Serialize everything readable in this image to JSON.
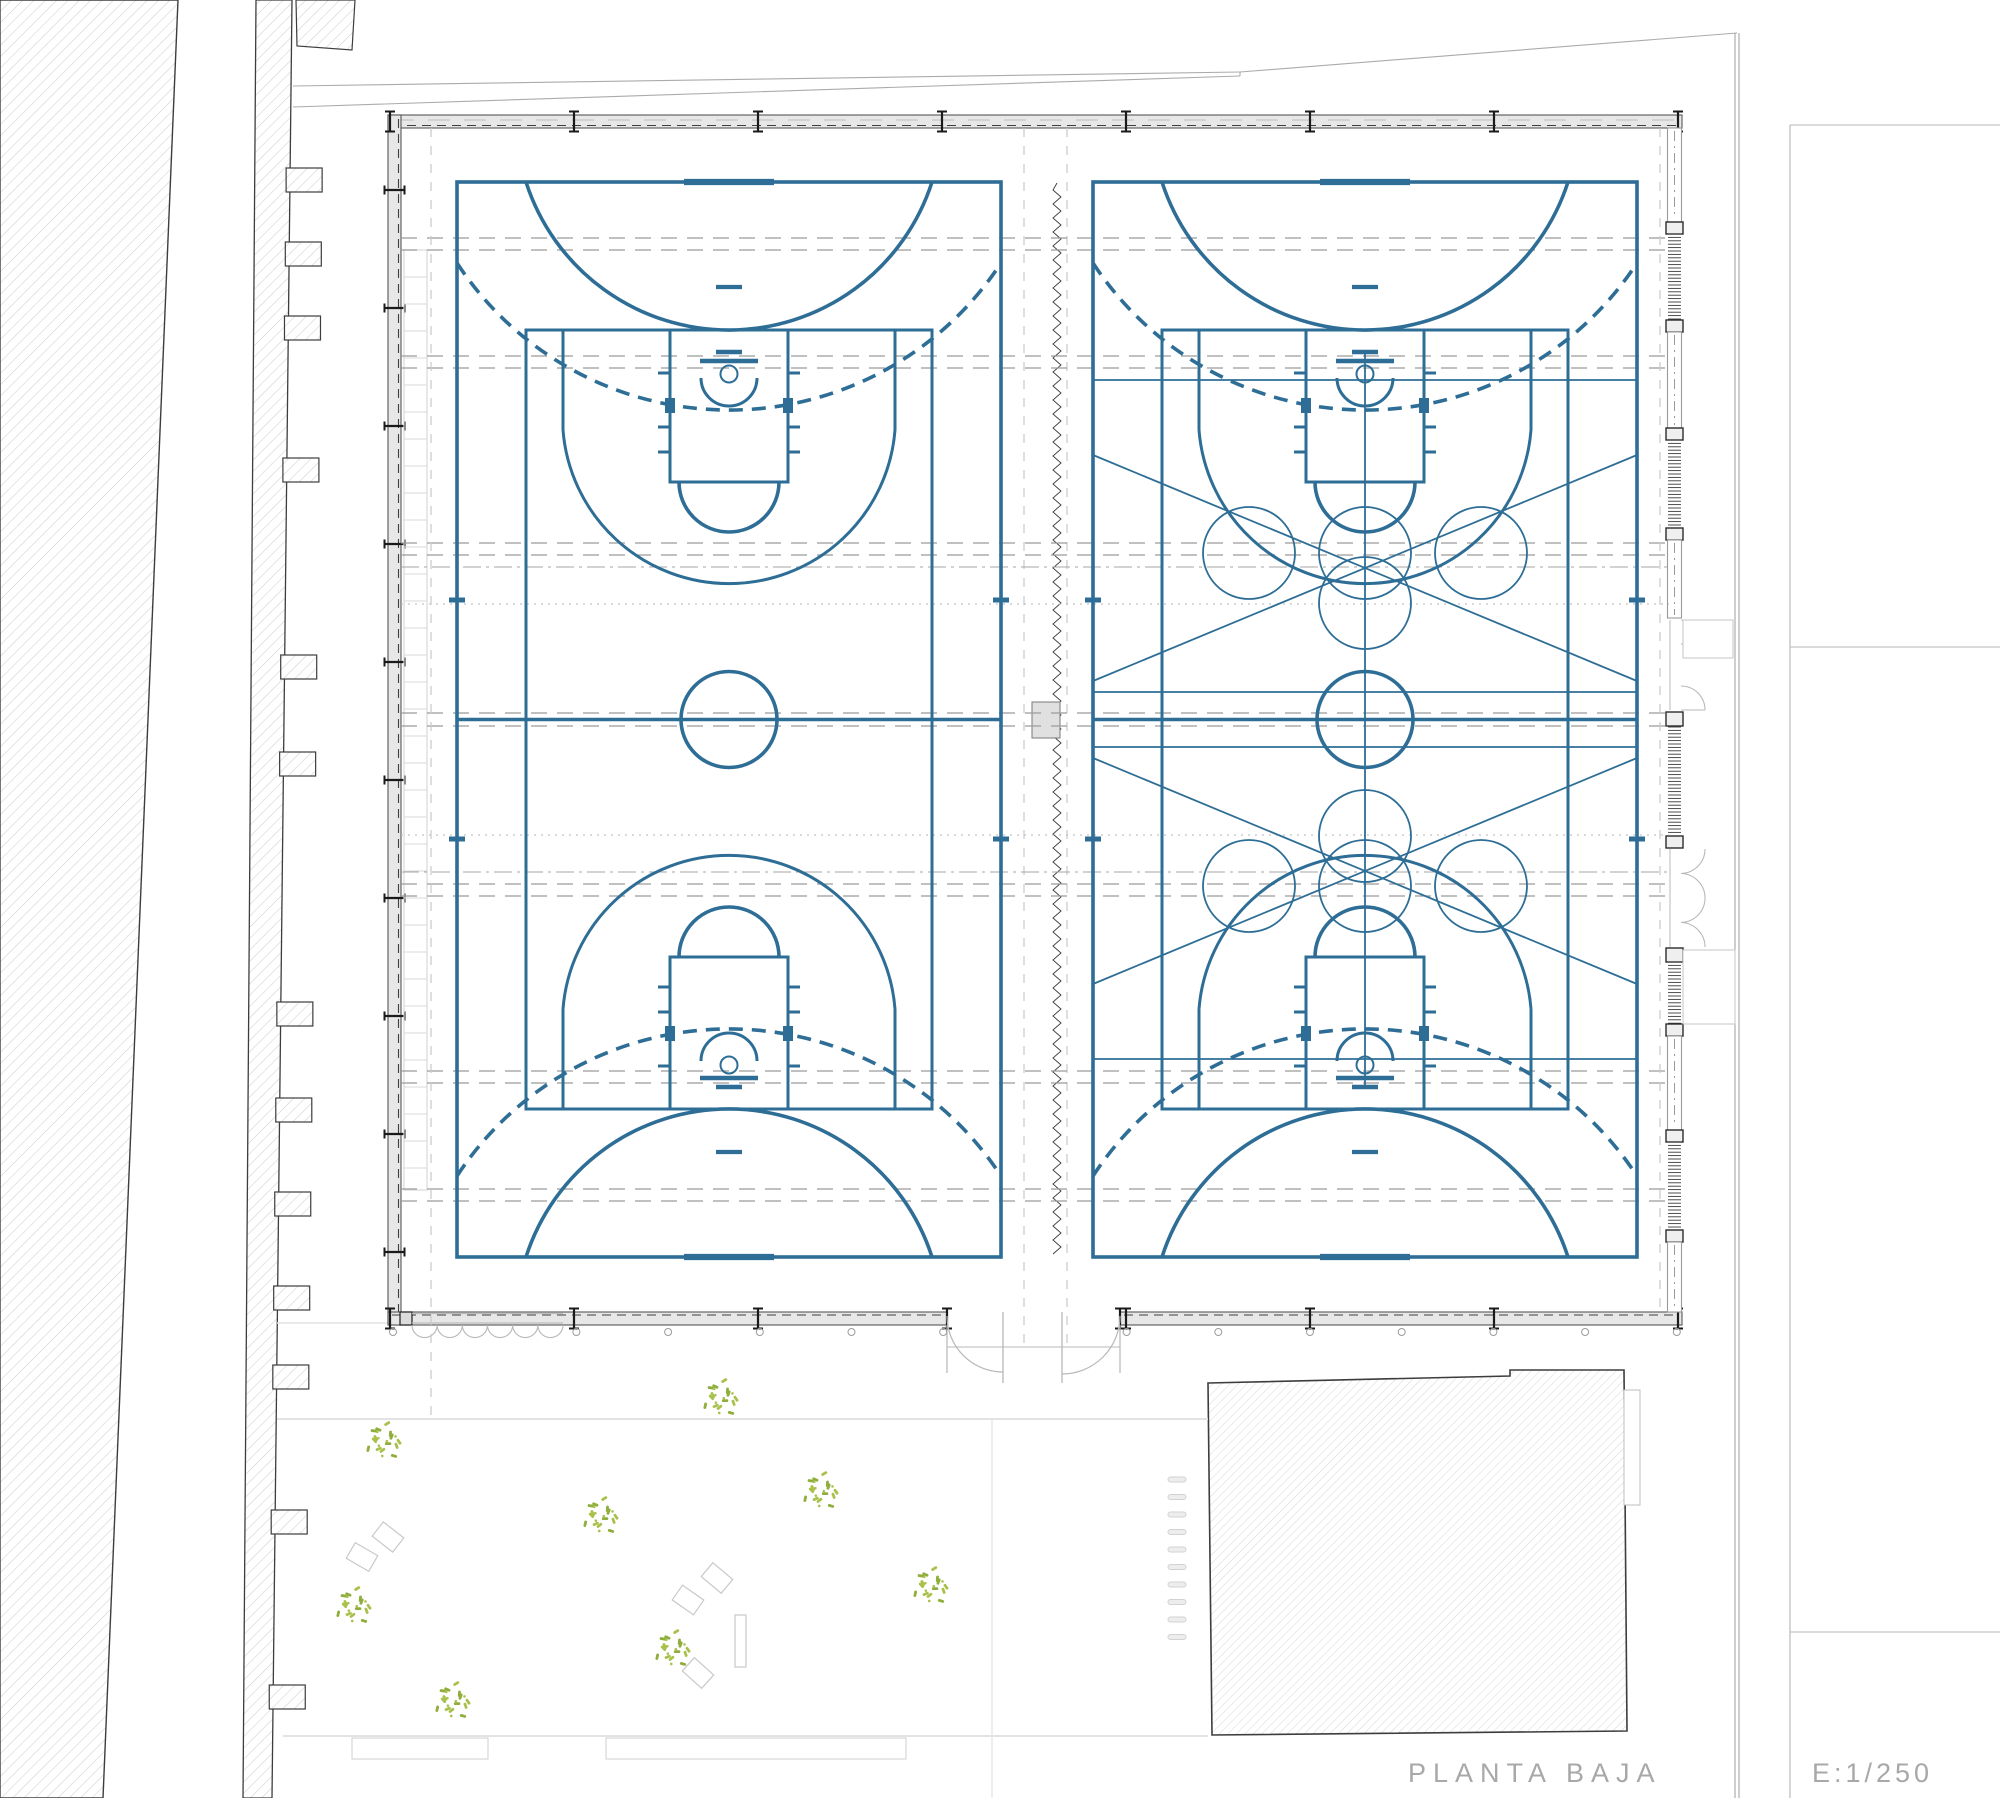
{
  "title": {
    "label": "PLANTA BAJA",
    "scale_label": "E:1/250"
  },
  "colors": {
    "court_blue": "#2e6e96",
    "tree_green_a": "#a9c14c",
    "tree_green_b": "#8fae3c",
    "hatch_line": "#cfcfcf",
    "hatch_edge": "#3d3d3d",
    "wall_fill": "#e7e7e7",
    "wall_edge": "#565656",
    "column_dark": "#1a1a1a",
    "gray_dash": "#9b9b9b",
    "gray_dashdot": "#a5a5a5",
    "gray_dot": "#b5b5b5",
    "light_dash": "#c9c9c9",
    "ladder": "#d8d8d8",
    "yard_line": "#e3e3e3",
    "bench_line": "#c9c9c9",
    "thin_gray": "#ababab",
    "title_gray": "#a8a8a8",
    "louvre": "#3a3a3a",
    "window_line": "#9a9a9a",
    "door_line": "#b8b8b8"
  },
  "courts": {
    "hall_centers": [
      729,
      1365
    ],
    "overlay_hall_index": 1,
    "center_y": 719.5,
    "outer": {
      "y1": 182,
      "y2": 1257,
      "half_w": 272
    },
    "inner": {
      "y1": 330,
      "y2": 1109,
      "half_w": 203
    },
    "center_circle_r": 48,
    "dome": {
      "half_w": 203,
      "r": 213.2
    },
    "dashed_arc": {
      "half_w": 272,
      "end_y_off": 81,
      "r": 325.1
    },
    "penalty_mark": {
      "y_off": 105,
      "w": 26
    },
    "end_tick_w": 90,
    "throwin_y": [
      600,
      839
    ],
    "key": {
      "half_w": 59,
      "len": 152,
      "ft_r": 50
    },
    "backboard": {
      "support_y_off": 22,
      "support_half_w": 13,
      "board_y_off": 31,
      "board_half_w": 29,
      "hoop_y_off": 44,
      "hoop_r": 8.5,
      "nocharge_r": 28,
      "nocharge_y_off": 48
    },
    "three_pt": {
      "x_off": 166,
      "straight_end_y_off": 100,
      "r": 166.5
    },
    "hashes_y_off": [
      43,
      97,
      122
    ],
    "hash_len": 12,
    "block": {
      "y_off": 68,
      "h": 15,
      "w": 10
    },
    "overlay": {
      "hlines_y": [
        380,
        692,
        747,
        1059
      ],
      "vline": {
        "y1": 352,
        "y2": 1087
      },
      "circle_r": 46,
      "row_dx": 116,
      "rows": [
        {
          "y": 553,
          "extra_y": 603
        },
        {
          "y": 886,
          "extra_y": 836
        }
      ],
      "diagonals": [
        [
          455,
          681
        ],
        [
          984,
          758
        ]
      ]
    },
    "stroke": {
      "thick": 3.6,
      "med": 3.0,
      "thin": 1.8,
      "dash": "14 9"
    }
  },
  "building": {
    "outer": {
      "x1": 388,
      "y1": 115,
      "x2": 1682,
      "y2": 1325
    },
    "wall_t": 13,
    "top_columns_x": [
      390,
      574,
      758,
      942,
      1126,
      1310,
      1494,
      1678
    ],
    "bottom_columns_x": [
      390,
      574,
      758,
      1126,
      1310,
      1494,
      1678
    ],
    "left_columns_y": [
      190,
      308,
      426,
      544,
      662,
      780,
      898,
      1016,
      1134,
      1252
    ],
    "ladder": {
      "x1": 404,
      "x2": 427,
      "y1": 250,
      "y2": 1190,
      "step": 27
    },
    "right_wall": {
      "x1": 1668,
      "x2": 1681,
      "segments": [
        {
          "t": "win",
          "y1": 128,
          "y2": 222
        },
        {
          "t": "col",
          "y1": 222,
          "y2": 234
        },
        {
          "t": "louv",
          "y1": 234,
          "y2": 320
        },
        {
          "t": "col",
          "y1": 320,
          "y2": 332
        },
        {
          "t": "win",
          "y1": 332,
          "y2": 428
        },
        {
          "t": "col",
          "y1": 428,
          "y2": 440
        },
        {
          "t": "louv",
          "y1": 440,
          "y2": 528
        },
        {
          "t": "col",
          "y1": 528,
          "y2": 540
        },
        {
          "t": "win",
          "y1": 540,
          "y2": 618
        },
        {
          "t": "door2",
          "y1": 620,
          "y2": 710
        },
        {
          "t": "col",
          "y1": 712,
          "y2": 726
        },
        {
          "t": "louv",
          "y1": 727,
          "y2": 835
        },
        {
          "t": "col",
          "y1": 836,
          "y2": 848
        },
        {
          "t": "door4",
          "y1": 849,
          "y2": 947
        },
        {
          "t": "col",
          "y1": 948,
          "y2": 962
        },
        {
          "t": "louv",
          "y1": 962,
          "y2": 1024
        },
        {
          "t": "col",
          "y1": 1024,
          "y2": 1036
        },
        {
          "t": "win",
          "y1": 1036,
          "y2": 1130
        },
        {
          "t": "col",
          "y1": 1130,
          "y2": 1142
        },
        {
          "t": "louv",
          "y1": 1142,
          "y2": 1230
        },
        {
          "t": "col",
          "y1": 1230,
          "y2": 1242
        },
        {
          "t": "win",
          "y1": 1242,
          "y2": 1312
        }
      ],
      "ext_slabs": [
        {
          "x": 1683,
          "y": 620,
          "w": 50,
          "h": 38
        },
        {
          "x": 1683,
          "y": 950,
          "w": 52,
          "h": 74
        }
      ]
    },
    "bottom_doors": {
      "folding": {
        "x1": 412,
        "x2": 563,
        "scallops": 6,
        "jamb": {
          "x": 400,
          "w": 12
        }
      },
      "double": {
        "jamb_l": 947,
        "jamb_r": 1120,
        "leaf_l": 1003,
        "leaf_r": 1062,
        "depth": 58,
        "threshold_y": 1347
      },
      "post_dots": {
        "x0": 393,
        "dx": 91.7,
        "count": 15,
        "y": 1332,
        "r": 3.5,
        "skip_x": [
          484,
          1033
        ]
      }
    },
    "corridor": {
      "zigzag_x": 1057,
      "zz_y1": 183,
      "zz_y2": 1256,
      "dash_x": [
        1024,
        1067
      ],
      "rect": {
        "x": 1032,
        "y": 702,
        "w": 28,
        "h": 36
      }
    }
  },
  "overhead": {
    "dashed_pairs_y": [
      238,
      250,
      356,
      368,
      543,
      555,
      713,
      726,
      884,
      896,
      1071,
      1083,
      1189,
      1201
    ],
    "dashdot_y": [
      567,
      872
    ],
    "dotted_y": [
      604,
      835
    ],
    "x1": 401,
    "x2": 1669,
    "vertical_dash_x": [
      431,
      1660
    ]
  },
  "site": {
    "left_parcel": {
      "points": "0,0 178,0 103,1798 0,1798"
    },
    "band": {
      "points": "256,0 292,0 272,1798 243,1798",
      "teeth_y": [
        168,
        242,
        316,
        458,
        655,
        752,
        1002,
        1098,
        1192,
        1286,
        1365,
        1510,
        1685
      ],
      "tooth_h": 24,
      "tooth_len": 32
    },
    "north_patch": {
      "points": "296,0 355,0 352,50 297,46"
    },
    "street_lines": [
      {
        "x1": 293,
        "y1": 86,
        "x2": 1240,
        "y2": 72
      },
      {
        "x1": 293,
        "y1": 107,
        "x2": 1240,
        "y2": 76
      },
      {
        "x1": 1240,
        "y1": 72,
        "x2": 1737,
        "y2": 33
      }
    ],
    "boundary_double_x": [
      1735,
      1739
    ],
    "boundary_y": {
      "y1": 33,
      "y2": 1798
    },
    "neighbor_right": {
      "vline": {
        "x": 1790,
        "y1": 125,
        "y2": 1798
      },
      "hlines": [
        {
          "y": 125,
          "x1": 1790,
          "x2": 2000
        },
        {
          "y": 647,
          "x1": 1790,
          "x2": 2000
        },
        {
          "y": 1632,
          "x1": 1790,
          "x2": 2000
        }
      ]
    },
    "bottom_building": {
      "points": "1208,1383 1510,1376 1510,1370 1624,1370 1627,1731 1212,1735",
      "side_rect": {
        "x": 1624,
        "y": 1390,
        "w": 16,
        "h": 115
      }
    },
    "stair_marks": {
      "x": 1168,
      "w": 18,
      "h": 5,
      "y0": 1477,
      "dy": 17.5,
      "count": 10
    },
    "yard": {
      "walk_line": {
        "y": 1419,
        "x1": 277,
        "x2": 1208
      },
      "side_line": {
        "y": 1323,
        "x1": 277,
        "x2": 388
      },
      "bottom_line": {
        "y": 1736,
        "x1": 283,
        "x2": 1208
      },
      "vline": {
        "x": 992,
        "y1": 1419,
        "y2": 1798
      },
      "planters": [
        {
          "x": 352,
          "y": 1738,
          "w": 136,
          "h": 21
        },
        {
          "x": 606,
          "y": 1738,
          "w": 300,
          "h": 21
        }
      ]
    },
    "trees": [
      {
        "x": 720,
        "y": 1397
      },
      {
        "x": 383,
        "y": 1440
      },
      {
        "x": 820,
        "y": 1490
      },
      {
        "x": 600,
        "y": 1515
      },
      {
        "x": 930,
        "y": 1585
      },
      {
        "x": 353,
        "y": 1605
      },
      {
        "x": 672,
        "y": 1648
      },
      {
        "x": 452,
        "y": 1700
      }
    ],
    "benches": [
      {
        "x": 388,
        "y": 1537,
        "rot": 38
      },
      {
        "x": 362,
        "y": 1557,
        "rot": 30
      },
      {
        "x": 717,
        "y": 1578,
        "rot": 40
      },
      {
        "x": 688,
        "y": 1600,
        "rot": 35
      },
      {
        "x": 698,
        "y": 1673,
        "rot": 42
      }
    ],
    "bench_rect": {
      "x": 735,
      "y": 1615,
      "w": 11,
      "h": 52
    }
  }
}
